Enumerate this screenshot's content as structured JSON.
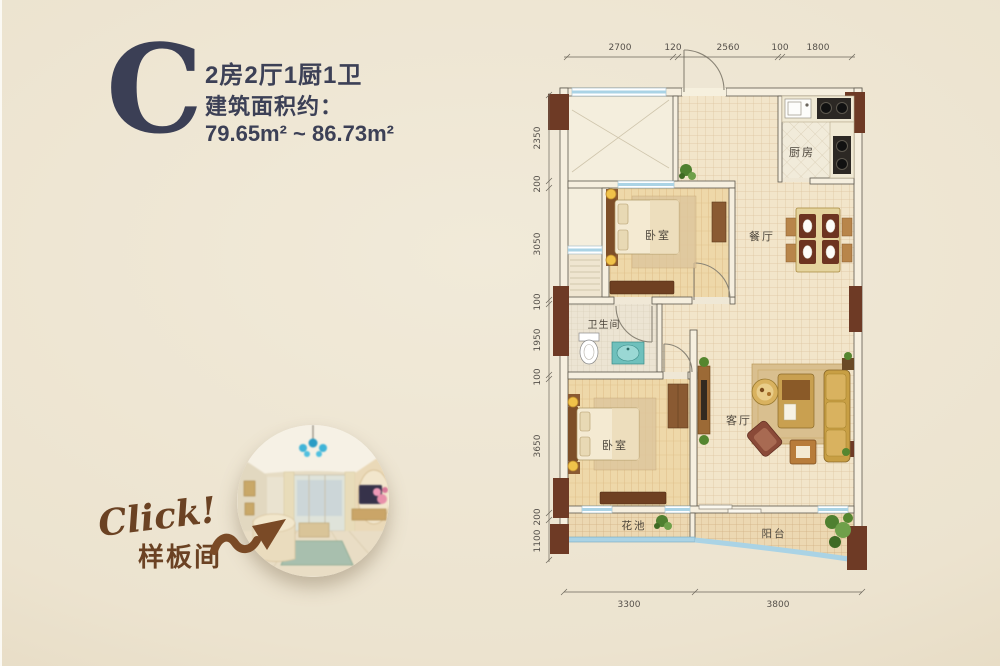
{
  "title": {
    "letter": "C",
    "layout": "2房2厅1厨1卫",
    "area_label": "建筑面积约：",
    "area_value": "79.65m² ~ 86.73m²"
  },
  "promo": {
    "click_label": "Click!",
    "sample_room_label": "样板间"
  },
  "plan": {
    "rooms": {
      "kitchen": "厨房",
      "dining": "餐厅",
      "bedroom1": "卧室",
      "bathroom": "卫生间",
      "bedroom2": "卧室",
      "living": "客厅",
      "flower_bed": "花池",
      "balcony": "阳台"
    },
    "dims": {
      "top": [
        "2700",
        "120",
        "2560",
        "100",
        "1800"
      ],
      "left": [
        "2350",
        "200",
        "3050",
        "100",
        "1950",
        "100",
        "3650",
        "200",
        "1100"
      ],
      "bottom": [
        "3300",
        "3800"
      ]
    },
    "colors": {
      "wall_fill": "#f6efdf",
      "column_brown": "#6e3a25",
      "window_blue": "#aad3e5",
      "title_navy": "#3b3f55",
      "promo_brown": "#6b4223"
    }
  }
}
